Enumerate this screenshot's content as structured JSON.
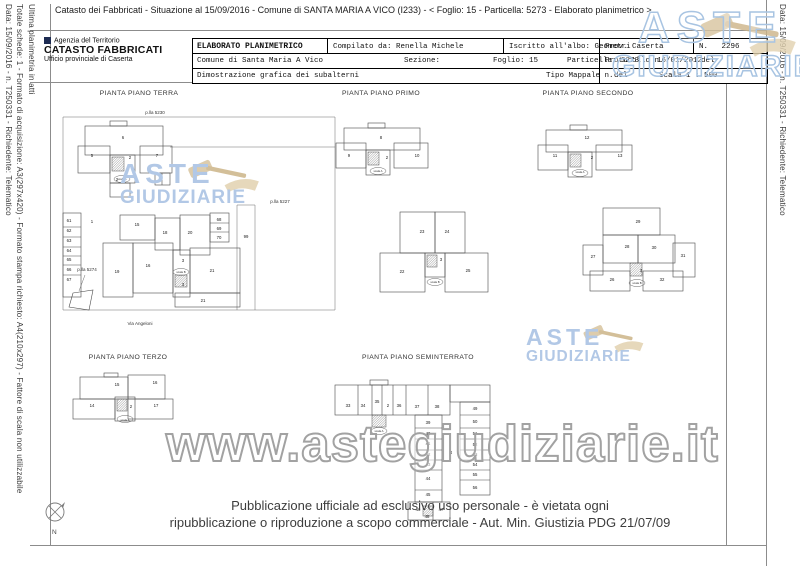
{
  "header": {
    "text": "Catasto dei Fabbricati - Situazione al 15/09/2016 - Comune di SANTA MARIA A VICO (I233) - <  Foglio: 15 - Particella: 5273 - Elaborato planimetrico >"
  },
  "margins": {
    "left_data": "Data: 15/09/2016 - n. T250331 - Richiedente: Telematico",
    "left_totale": "Totale schede: 1 - Formato di acquisizione: A3(297x420) - Formato stampa richiesto: A4(210x297) - Fattore di scala non utilizzabile",
    "left_ultima": "Ultima planimetria in atti",
    "right_data": "Data: 15/09/2016 - n. T250331 - Richiedente: Telematico"
  },
  "logo": {
    "line1": "Agenzia del Territorio",
    "line2": "CATASTO FABBRICATI",
    "line3": "Ufficio provinciale di Caserta"
  },
  "info_table": {
    "title": "ELABORATO PLANIMETRICO",
    "compilato": "Compilato da: Renella Michele",
    "iscritto": "Iscritto all'albo: Geometri",
    "prov": "Prov. Caserta",
    "num": "N.   2296",
    "comune": "Comune di Santa Maria A Vico",
    "sezione": "Sezione:",
    "foglio": "Foglio: 15",
    "particella": "Particella: 5273",
    "protocollo": "Protocollo n.",
    "prot_date": "16/01/2012",
    "prot_del": "del",
    "dimostrazione": "Dimostrazione grafica dei subalterni",
    "tipo_mappale": "Tipo Mappale n.",
    "tm_del": "del",
    "scala": "Scala 1 : 500"
  },
  "plans": [
    {
      "id": "terra",
      "title": "PIANTA PIANO TERRA",
      "rooms": [
        {
          "n": "6",
          "x": 68,
          "y": 34
        },
        {
          "n": "5",
          "x": 37,
          "y": 52
        },
        {
          "n": "7",
          "x": 102,
          "y": 52
        },
        {
          "n": "2",
          "x": 75,
          "y": 54
        },
        {
          "n": "2",
          "x": 62,
          "y": 76
        },
        {
          "n": "1",
          "x": 37,
          "y": 118
        },
        {
          "n": "15",
          "x": 82,
          "y": 121
        },
        {
          "n": "18",
          "x": 110,
          "y": 129
        },
        {
          "n": "20",
          "x": 135,
          "y": 129
        },
        {
          "n": "19",
          "x": 62,
          "y": 168
        },
        {
          "n": "16",
          "x": 93,
          "y": 162
        },
        {
          "n": "3",
          "x": 128,
          "y": 157
        },
        {
          "n": "3",
          "x": 128,
          "y": 181
        },
        {
          "n": "21",
          "x": 157,
          "y": 167
        },
        {
          "n": "21",
          "x": 148,
          "y": 197
        },
        {
          "n": "61",
          "x": 14,
          "y": 117
        },
        {
          "n": "62",
          "x": 14,
          "y": 127
        },
        {
          "n": "63",
          "x": 14,
          "y": 137
        },
        {
          "n": "64",
          "x": 14,
          "y": 147
        },
        {
          "n": "65",
          "x": 14,
          "y": 156
        },
        {
          "n": "66",
          "x": 14,
          "y": 166
        },
        {
          "n": "67",
          "x": 14,
          "y": 176
        },
        {
          "n": "68",
          "x": 164,
          "y": 116
        },
        {
          "n": "69",
          "x": 164,
          "y": 125
        },
        {
          "n": "70",
          "x": 164,
          "y": 134
        },
        {
          "n": "99",
          "x": 191,
          "y": 133
        }
      ],
      "labels": [
        {
          "t": "p.lla 5230",
          "x": 100,
          "y": 9
        },
        {
          "t": "p.lla 5227",
          "x": 225,
          "y": 98
        },
        {
          "t": "p.lla 5274",
          "x": 32,
          "y": 166
        },
        {
          "t": "Via Angeloni",
          "x": 85,
          "y": 220
        },
        {
          "t": "scala A",
          "x": 67,
          "y": 75,
          "s": 2.8
        },
        {
          "t": "scala B",
          "x": 126,
          "y": 168,
          "s": 2.8
        }
      ]
    },
    {
      "id": "primo",
      "title": "PIANTA PIANO PRIMO",
      "rooms": [
        {
          "n": "8",
          "x": 51,
          "y": 34
        },
        {
          "n": "9",
          "x": 19,
          "y": 52
        },
        {
          "n": "10",
          "x": 87,
          "y": 52
        },
        {
          "n": "2",
          "x": 57,
          "y": 54
        },
        {
          "n": "23",
          "x": 92,
          "y": 128
        },
        {
          "n": "24",
          "x": 117,
          "y": 128
        },
        {
          "n": "22",
          "x": 72,
          "y": 168
        },
        {
          "n": "25",
          "x": 138,
          "y": 167
        },
        {
          "n": "3",
          "x": 111,
          "y": 156
        }
      ],
      "labels": [
        {
          "t": "scala A",
          "x": 48,
          "y": 67,
          "s": 2.8
        },
        {
          "t": "scala B",
          "x": 105,
          "y": 178,
          "s": 2.8
        }
      ]
    },
    {
      "id": "secondo",
      "title": "PIANTA PIANO SECONDO",
      "rooms": [
        {
          "n": "12",
          "x": 52,
          "y": 34
        },
        {
          "n": "11",
          "x": 20,
          "y": 52
        },
        {
          "n": "13",
          "x": 85,
          "y": 52
        },
        {
          "n": "2",
          "x": 57,
          "y": 54
        },
        {
          "n": "29",
          "x": 103,
          "y": 118
        },
        {
          "n": "28",
          "x": 92,
          "y": 143
        },
        {
          "n": "30",
          "x": 119,
          "y": 144
        },
        {
          "n": "27",
          "x": 58,
          "y": 153
        },
        {
          "n": "31",
          "x": 148,
          "y": 152
        },
        {
          "n": "26",
          "x": 77,
          "y": 176
        },
        {
          "n": "32",
          "x": 127,
          "y": 176
        },
        {
          "n": "3",
          "x": 106,
          "y": 167
        }
      ],
      "labels": [
        {
          "t": "scala A",
          "x": 45,
          "y": 68,
          "s": 2.8
        },
        {
          "t": "scala B",
          "x": 102,
          "y": 179,
          "s": 2.8
        }
      ]
    },
    {
      "id": "terzo",
      "title": "PIANTA PIANO TERZO",
      "rooms": [
        {
          "n": "15",
          "x": 57,
          "y": 21
        },
        {
          "n": "16",
          "x": 95,
          "y": 19
        },
        {
          "n": "14",
          "x": 32,
          "y": 42
        },
        {
          "n": "17",
          "x": 96,
          "y": 42
        },
        {
          "n": "2",
          "x": 71,
          "y": 43
        }
      ],
      "labels": [
        {
          "t": "scala A",
          "x": 65,
          "y": 56,
          "s": 2.8
        }
      ]
    },
    {
      "id": "seminterrato",
      "title": "PIANTA PIANO SEMINTERRATO",
      "rooms": [
        {
          "n": "33",
          "x": 18,
          "y": 42
        },
        {
          "n": "34",
          "x": 33,
          "y": 42
        },
        {
          "n": "35",
          "x": 47,
          "y": 38
        },
        {
          "n": "2",
          "x": 58,
          "y": 42
        },
        {
          "n": "36",
          "x": 69,
          "y": 42
        },
        {
          "n": "37",
          "x": 87,
          "y": 43
        },
        {
          "n": "38",
          "x": 107,
          "y": 43
        },
        {
          "n": "39",
          "x": 98,
          "y": 59
        },
        {
          "n": "40",
          "x": 98,
          "y": 70
        },
        {
          "n": "41",
          "x": 98,
          "y": 80
        },
        {
          "n": "42",
          "x": 98,
          "y": 91
        },
        {
          "n": "43",
          "x": 98,
          "y": 101
        },
        {
          "n": "44",
          "x": 98,
          "y": 115
        },
        {
          "n": "45",
          "x": 98,
          "y": 131
        },
        {
          "n": "46",
          "x": 88,
          "y": 146
        },
        {
          "n": "47",
          "x": 111,
          "y": 146
        },
        {
          "n": "48",
          "x": 97,
          "y": 153
        },
        {
          "n": "49",
          "x": 145,
          "y": 45
        },
        {
          "n": "50",
          "x": 145,
          "y": 58
        },
        {
          "n": "51",
          "x": 145,
          "y": 70
        },
        {
          "n": "52",
          "x": 145,
          "y": 81
        },
        {
          "n": "53",
          "x": 145,
          "y": 91
        },
        {
          "n": "54",
          "x": 145,
          "y": 101
        },
        {
          "n": "55",
          "x": 145,
          "y": 111
        },
        {
          "n": "56",
          "x": 145,
          "y": 124
        },
        {
          "n": "4",
          "x": 121,
          "y": 89
        }
      ],
      "labels": [
        {
          "t": "scala A",
          "x": 49,
          "y": 67,
          "s": 2.8
        }
      ]
    }
  ],
  "watermarks": {
    "aste": "ASTE",
    "giudiziarie": "GIUDIZIARIE",
    "url": "www.astegiudiziarie.it"
  },
  "footer": {
    "line1": "Pubblicazione ufficiale ad esclusivo uso personale - è vietata ogni",
    "line2": "ripubblicazione o riproduzione a scopo commerciale - Aut. Min. Giustizia PDG 21/07/09"
  },
  "compass": {
    "label": "N"
  }
}
